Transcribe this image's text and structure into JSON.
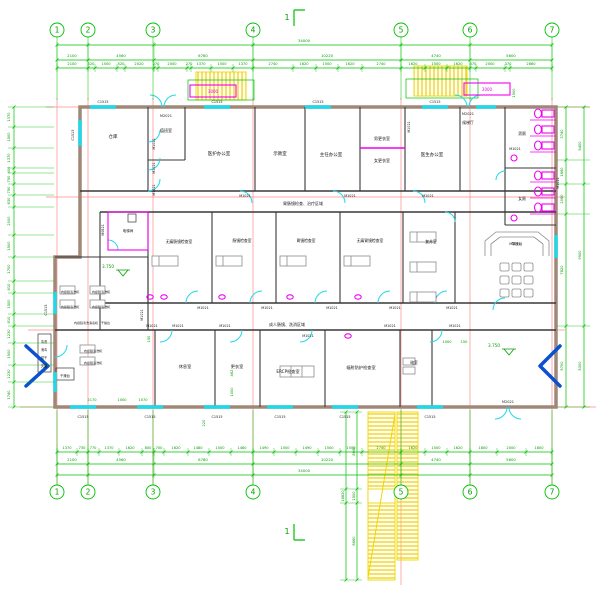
{
  "grid": {
    "labels": [
      "1",
      "2",
      "3",
      "4",
      "5",
      "6",
      "7"
    ]
  },
  "section_marks": {
    "top": "1",
    "bottom": "1"
  },
  "dimensions": {
    "top_total": "34000",
    "top_segments": [
      "2100",
      "4560",
      "6780",
      "10220",
      "4740",
      "5600"
    ],
    "top_detail": [
      "2100",
      "520",
      "1500",
      "520",
      "2020",
      "270",
      "2000",
      "270",
      "1370",
      "1500",
      "1370",
      "2740",
      "1620",
      "1500",
      "1620",
      "2740",
      "1620",
      "1500",
      "1620",
      "370",
      "2000",
      "370",
      "2860"
    ],
    "bottom_total": "34000",
    "bottom_segments": [
      "2100",
      "4560",
      "6780",
      "10220",
      "4740",
      "5600"
    ],
    "bottom_detail": [
      "1370",
      "730",
      "770",
      "1370",
      "1620",
      "800",
      "700",
      "1620",
      "1480",
      "1500",
      "1480",
      "1490",
      "1500",
      "1490",
      "1500",
      "1500",
      "2740",
      "1620",
      "1500",
      "1620",
      "1800",
      "2000",
      "1800"
    ],
    "left": [
      "1370",
      "1500",
      "1370",
      "400",
      "750",
      "750",
      "830",
      "2000",
      "1500",
      "1700",
      "810",
      "1500",
      "810",
      "1230",
      "1500",
      "1230",
      "1740"
    ],
    "right_inner": [
      "3740",
      "1660",
      "2080",
      "7820",
      "5700"
    ],
    "right_outer": [
      "5400",
      "9900",
      "5300"
    ],
    "ramp": [
      "8660",
      "1500",
      "8660"
    ],
    "ramp_total": "18820"
  },
  "annotations": [
    {
      "n": "room-storage",
      "t": "仓库",
      "x": 113,
      "y": 138,
      "s": 4.5
    },
    {
      "n": "room-duty",
      "t": "值班室",
      "x": 166,
      "y": 132,
      "s": 4
    },
    {
      "n": "room-staff-office",
      "t": "医护办公室",
      "x": 219,
      "y": 155,
      "s": 4.5
    },
    {
      "n": "room-demo",
      "t": "示教室",
      "x": 280,
      "y": 155,
      "s": 4.5
    },
    {
      "n": "room-director-office",
      "t": "主任办公室",
      "x": 331,
      "y": 156,
      "s": 4.5
    },
    {
      "n": "room-male-locker",
      "t": "男更衣室",
      "x": 382,
      "y": 140,
      "s": 4
    },
    {
      "n": "room-female-locker",
      "t": "女更衣室",
      "x": 382,
      "y": 162,
      "s": 4
    },
    {
      "n": "room-doctor-office",
      "t": "医生办公室",
      "x": 432,
      "y": 156,
      "s": 4.5
    },
    {
      "n": "room-lift-lobby",
      "t": "候梯厅",
      "x": 468,
      "y": 124,
      "s": 3.8
    },
    {
      "n": "room-male-wc",
      "t": "男厕",
      "x": 522,
      "y": 135,
      "s": 3.8
    },
    {
      "n": "room-female-wc",
      "t": "女厕",
      "x": 522,
      "y": 200,
      "s": 3.8
    },
    {
      "n": "room-painless-colonoscopy",
      "t": "无痛肠镜检查室",
      "x": 179,
      "y": 243,
      "s": 3.8
    },
    {
      "n": "room-colonoscopy",
      "t": "肠镜检查室",
      "x": 242,
      "y": 242,
      "s": 3.8
    },
    {
      "n": "room-gastroscopy",
      "t": "胃镜检查室",
      "x": 306,
      "y": 242,
      "s": 3.8
    },
    {
      "n": "room-painless-gastroscopy",
      "t": "无痛胃镜检查室",
      "x": 370,
      "y": 242,
      "s": 3.8
    },
    {
      "n": "room-recovery",
      "t": "复苏室",
      "x": 431,
      "y": 243,
      "s": 3.8
    },
    {
      "n": "room-lift",
      "t": "电梯间",
      "x": 128,
      "y": 232,
      "s": 3.6
    },
    {
      "n": "room-rest",
      "t": "休息室",
      "x": 185,
      "y": 368,
      "s": 4.2
    },
    {
      "n": "room-changing",
      "t": "更衣室",
      "x": 237,
      "y": 368,
      "s": 4.2
    },
    {
      "n": "room-ercp",
      "t": "ERCP检查室",
      "x": 288,
      "y": 373,
      "s": 4.2
    },
    {
      "n": "room-radiation",
      "t": "辐射防护检查室",
      "x": 361,
      "y": 369,
      "s": 4.2
    },
    {
      "n": "room-dark",
      "t": "暗室",
      "x": 414,
      "y": 364,
      "s": 3.8
    },
    {
      "n": "reception-desk-label",
      "t": "导医台",
      "x": 517,
      "y": 245,
      "s": 3.6
    },
    {
      "n": "label-endoscope-washer",
      "t": "内窥镜清洗机",
      "x": 70,
      "y": 293,
      "s": 3.1
    },
    {
      "n": "label-endoscope-washer",
      "t": "内窥镜清洗机",
      "x": 101,
      "y": 293,
      "s": 3.1
    },
    {
      "n": "label-endoscope-washer",
      "t": "内窥镜清洗机",
      "x": 70,
      "y": 308,
      "s": 3.1
    },
    {
      "n": "label-endoscope-washer",
      "t": "内窥镜清洗机",
      "x": 101,
      "y": 308,
      "s": 3.1
    },
    {
      "n": "label-endoscope-washer",
      "t": "内窥镜清洗机",
      "x": 93,
      "y": 352,
      "s": 3.1
    },
    {
      "n": "label-endoscope-washer",
      "t": "内窥镜清洗机",
      "x": 93,
      "y": 364,
      "s": 3.1
    },
    {
      "n": "label-dry-bench",
      "t": "干燥台",
      "x": 65,
      "y": 377,
      "s": 3.3
    },
    {
      "n": "label-wash-caption",
      "t": "内窥镜清洗消毒机　干燥台",
      "x": 92,
      "y": 324,
      "s": 3
    },
    {
      "n": "label-process-step",
      "t": "清洗",
      "x": 44,
      "y": 343,
      "s": 3.2
    },
    {
      "n": "label-process-step",
      "t": "消毒",
      "x": 44,
      "y": 351,
      "s": 3.2
    },
    {
      "n": "label-process-step",
      "t": "烘干",
      "x": 44,
      "y": 359,
      "s": 3.2
    },
    {
      "n": "label-process-step",
      "t": "灭菌",
      "x": 44,
      "y": 367,
      "s": 3.2
    },
    {
      "n": "zone-exam-treatment",
      "t": "胃肠镜检查、治疗区域",
      "x": 303,
      "y": 205,
      "s": 4
    },
    {
      "n": "zone-adult-colonoscopy",
      "t": "成人肠镜、洗消区域",
      "x": 287,
      "y": 326,
      "s": 4
    },
    {
      "n": "elevation-left",
      "t": "3.750",
      "x": 108,
      "y": 268,
      "s": 4.2,
      "c": "tg"
    },
    {
      "n": "elevation-right",
      "t": "3.750",
      "x": 494,
      "y": 347,
      "s": 4.2,
      "c": "tg"
    },
    {
      "n": "door-code",
      "t": "M2021",
      "x": 166,
      "y": 117,
      "s": 3.5
    },
    {
      "n": "door-code",
      "t": "M2021",
      "x": 468,
      "y": 115,
      "s": 3.5
    },
    {
      "n": "door-code",
      "t": "M2021",
      "x": 508,
      "y": 403,
      "s": 3.5
    },
    {
      "n": "door-code",
      "t": "M1021",
      "x": 245,
      "y": 197,
      "s": 3.4
    },
    {
      "n": "door-code",
      "t": "M1021",
      "x": 350,
      "y": 197,
      "s": 3.4
    },
    {
      "n": "door-code",
      "t": "M1021",
      "x": 428,
      "y": 197,
      "s": 3.4
    },
    {
      "n": "door-code",
      "t": "M1021",
      "x": 203,
      "y": 309,
      "s": 3.4
    },
    {
      "n": "door-code",
      "t": "M1021",
      "x": 267,
      "y": 309,
      "s": 3.4
    },
    {
      "n": "door-code",
      "t": "M1021",
      "x": 332,
      "y": 309,
      "s": 3.4
    },
    {
      "n": "door-code",
      "t": "M1021",
      "x": 395,
      "y": 309,
      "s": 3.4
    },
    {
      "n": "door-code",
      "t": "M1021",
      "x": 452,
      "y": 309,
      "s": 3.4
    },
    {
      "n": "door-code",
      "t": "M1021",
      "x": 152,
      "y": 327,
      "s": 3.4
    },
    {
      "n": "door-code",
      "t": "M1021",
      "x": 178,
      "y": 327,
      "s": 3.4
    },
    {
      "n": "door-code",
      "t": "M1021",
      "x": 225,
      "y": 327,
      "s": 3.4
    },
    {
      "n": "door-code",
      "t": "M1021",
      "x": 308,
      "y": 337,
      "s": 3.4
    },
    {
      "n": "door-code",
      "t": "M1021",
      "x": 390,
      "y": 327,
      "s": 3.4
    },
    {
      "n": "door-code",
      "t": "M1021",
      "x": 455,
      "y": 327,
      "s": 3.4
    },
    {
      "n": "door-code",
      "t": "M1021",
      "x": 515,
      "y": 150,
      "s": 3.4
    },
    {
      "n": "door-code",
      "t": "M1021",
      "x": 515,
      "y": 245,
      "s": 3.4
    },
    {
      "n": "door-code",
      "t": "M1021",
      "x": 155,
      "y": 144,
      "s": 3.4,
      "r": 1
    },
    {
      "n": "door-code",
      "t": "M1021",
      "x": 155,
      "y": 168,
      "s": 3.4,
      "r": 1
    },
    {
      "n": "door-code",
      "t": "M1021",
      "x": 155,
      "y": 190,
      "s": 3.4,
      "r": 1
    },
    {
      "n": "door-code",
      "t": "M1021",
      "x": 410,
      "y": 127,
      "s": 3.4,
      "r": 1
    },
    {
      "n": "door-code",
      "t": "M1021",
      "x": 143,
      "y": 315,
      "s": 3.4,
      "r": 1
    },
    {
      "n": "door-code",
      "t": "M1021",
      "x": 559,
      "y": 183,
      "s": 3.4,
      "r": 1
    },
    {
      "n": "door-code",
      "t": "M0821",
      "x": 104,
      "y": 230,
      "s": 3.4,
      "r": 1
    },
    {
      "n": "window-code",
      "t": "C1515",
      "x": 103,
      "y": 103,
      "s": 3.4
    },
    {
      "n": "window-code",
      "t": "C1515",
      "x": 217,
      "y": 103,
      "s": 3.4
    },
    {
      "n": "window-code",
      "t": "C1515",
      "x": 318,
      "y": 103,
      "s": 3.4
    },
    {
      "n": "window-code",
      "t": "C1515",
      "x": 435,
      "y": 103,
      "s": 3.4
    },
    {
      "n": "window-code",
      "t": "C1515",
      "x": 83,
      "y": 418,
      "s": 3.4
    },
    {
      "n": "window-code",
      "t": "C1515",
      "x": 150,
      "y": 418,
      "s": 3.4
    },
    {
      "n": "window-code",
      "t": "C1515",
      "x": 217,
      "y": 418,
      "s": 3.4
    },
    {
      "n": "window-code",
      "t": "C1515",
      "x": 280,
      "y": 418,
      "s": 3.4
    },
    {
      "n": "window-code",
      "t": "C1515",
      "x": 345,
      "y": 418,
      "s": 3.4
    },
    {
      "n": "window-code",
      "t": "C1515",
      "x": 430,
      "y": 418,
      "s": 3.4
    },
    {
      "n": "window-code",
      "t": "C1515",
      "x": 74,
      "y": 135,
      "s": 3.4,
      "r": 1
    },
    {
      "n": "window-code",
      "t": "C1515",
      "x": 47,
      "y": 310,
      "s": 3.4,
      "r": 1
    },
    {
      "n": "dim-3000",
      "t": "3000",
      "x": 213,
      "y": 93,
      "s": 4,
      "c": "tm"
    },
    {
      "n": "dim-3000",
      "t": "3000",
      "x": 487,
      "y": 91,
      "s": 4,
      "c": "tm"
    },
    {
      "n": "dim",
      "t": "2170",
      "x": 92,
      "y": 401,
      "s": 3.6,
      "c": "tg"
    },
    {
      "n": "dim",
      "t": "1000",
      "x": 122,
      "y": 401,
      "s": 3.6,
      "c": "tg"
    },
    {
      "n": "dim",
      "t": "1070",
      "x": 143,
      "y": 401,
      "s": 3.6,
      "c": "tg"
    },
    {
      "n": "dim",
      "t": "220",
      "x": 205,
      "y": 423,
      "s": 3.6,
      "c": "tg",
      "r": 1
    },
    {
      "n": "dim",
      "t": "1000",
      "x": 233,
      "y": 392,
      "s": 3.6,
      "c": "tg",
      "r": 1
    },
    {
      "n": "dim",
      "t": "462",
      "x": 233,
      "y": 373,
      "s": 3.6,
      "c": "tg",
      "r": 1
    },
    {
      "n": "dim",
      "t": "150",
      "x": 150,
      "y": 339,
      "s": 3.6,
      "c": "tg",
      "r": 1
    },
    {
      "n": "dim",
      "t": "1000",
      "x": 447,
      "y": 343,
      "s": 3.6,
      "c": "tg"
    },
    {
      "n": "dim",
      "t": "150",
      "x": 464,
      "y": 343,
      "s": 3.6,
      "c": "tg"
    },
    {
      "n": "dim",
      "t": "1500",
      "x": 515,
      "y": 93,
      "s": 3.6,
      "c": "tg",
      "r": 1
    }
  ]
}
